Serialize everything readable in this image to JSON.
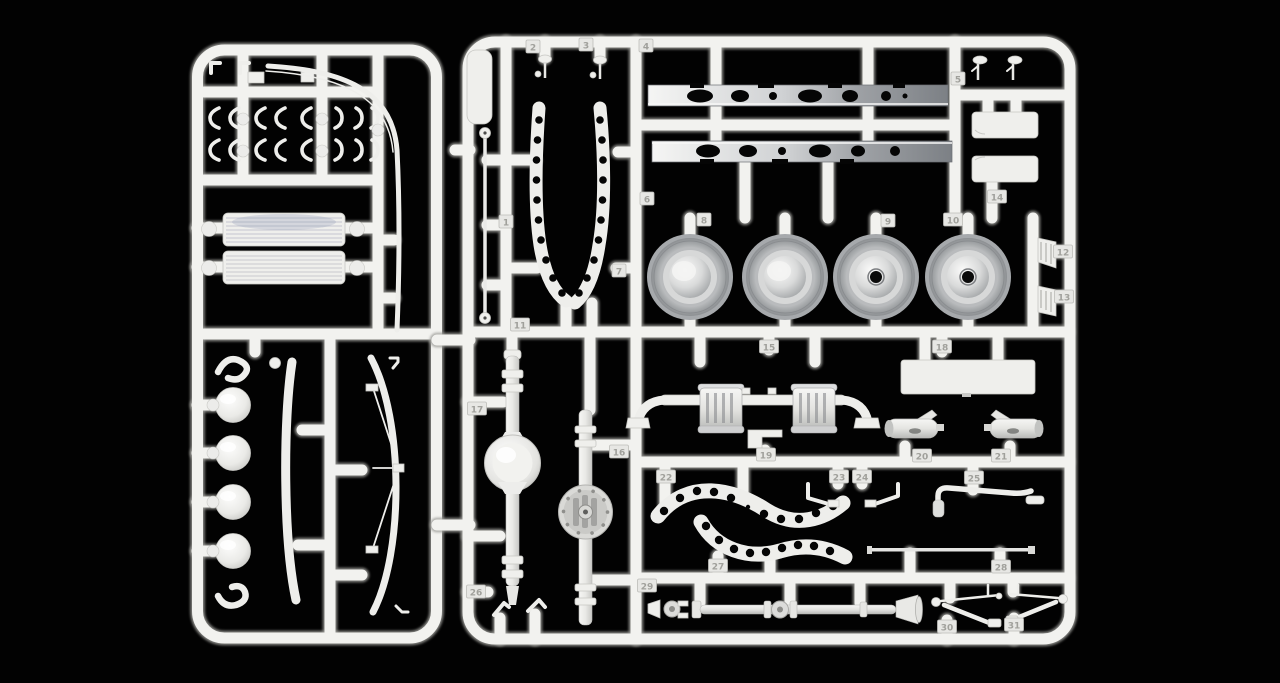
{
  "subject": "Photograph of two white injection-molded plastic model kit sprues (part trees) on a black background, containing truck chassis parts",
  "colors": {
    "background": "#020202",
    "plastic": "#f2f2ef",
    "plastic_shadow": "#9c9c98",
    "metal_light": "#f5f5f4",
    "metal_dark": "#7c8085",
    "tarp_tint": "#8e96b8"
  },
  "left_sprue": {
    "name": "left-sprue",
    "parts": [
      "small shackle hooks and clips (two rows)",
      "two ribbed tarpaulin rolls",
      "four dome caps",
      "two long canvas bows (one with cross bracing)",
      "two S-hooks",
      "long curved bow rod"
    ]
  },
  "right_sprue": {
    "name": "right-sprue",
    "parts": [
      "flat blade panel",
      "long rod with ball ends",
      "two perforated curved fender strips",
      "two ladder frame rails with lightening holes",
      "two rear-view mirrors (x2 pairs)",
      "two toolbox lids",
      "four wheel dishes (two with hub hole)",
      "two wedge blocks",
      "front axle with brake drums",
      "step bracket",
      "flat cargo panel",
      "two mufflers",
      "two axle housings (plain and bolted differential)",
      "two S-curved perforated mudguard strips",
      "two lever brackets",
      "bent exhaust pipe",
      "thin tie rod",
      "long driveshaft with universal joints",
      "two steering arm linkages",
      "two corner angles"
    ]
  },
  "part_tags": [
    {
      "label": "1",
      "x": 506,
      "y": 222
    },
    {
      "label": "2",
      "x": 533,
      "y": 47
    },
    {
      "label": "3",
      "x": 586,
      "y": 45
    },
    {
      "label": "4",
      "x": 646,
      "y": 46
    },
    {
      "label": "5",
      "x": 958,
      "y": 79
    },
    {
      "label": "6",
      "x": 647,
      "y": 199
    },
    {
      "label": "7",
      "x": 619,
      "y": 271
    },
    {
      "label": "8",
      "x": 704,
      "y": 220
    },
    {
      "label": "9",
      "x": 888,
      "y": 221
    },
    {
      "label": "10",
      "x": 953,
      "y": 220
    },
    {
      "label": "11",
      "x": 520,
      "y": 325
    },
    {
      "label": "12",
      "x": 1063,
      "y": 252
    },
    {
      "label": "13",
      "x": 1064,
      "y": 297
    },
    {
      "label": "14",
      "x": 997,
      "y": 197
    },
    {
      "label": "15",
      "x": 769,
      "y": 347
    },
    {
      "label": "16",
      "x": 619,
      "y": 452
    },
    {
      "label": "17",
      "x": 477,
      "y": 409
    },
    {
      "label": "18",
      "x": 942,
      "y": 347
    },
    {
      "label": "19",
      "x": 766,
      "y": 455
    },
    {
      "label": "20",
      "x": 922,
      "y": 456
    },
    {
      "label": "21",
      "x": 1001,
      "y": 456
    },
    {
      "label": "22",
      "x": 666,
      "y": 477
    },
    {
      "label": "23",
      "x": 839,
      "y": 477
    },
    {
      "label": "24",
      "x": 862,
      "y": 477
    },
    {
      "label": "25",
      "x": 974,
      "y": 478
    },
    {
      "label": "26",
      "x": 476,
      "y": 592
    },
    {
      "label": "27",
      "x": 718,
      "y": 566
    },
    {
      "label": "28",
      "x": 1001,
      "y": 567
    },
    {
      "label": "29",
      "x": 647,
      "y": 586
    },
    {
      "label": "30",
      "x": 947,
      "y": 627
    },
    {
      "label": "31",
      "x": 1014,
      "y": 625
    }
  ]
}
